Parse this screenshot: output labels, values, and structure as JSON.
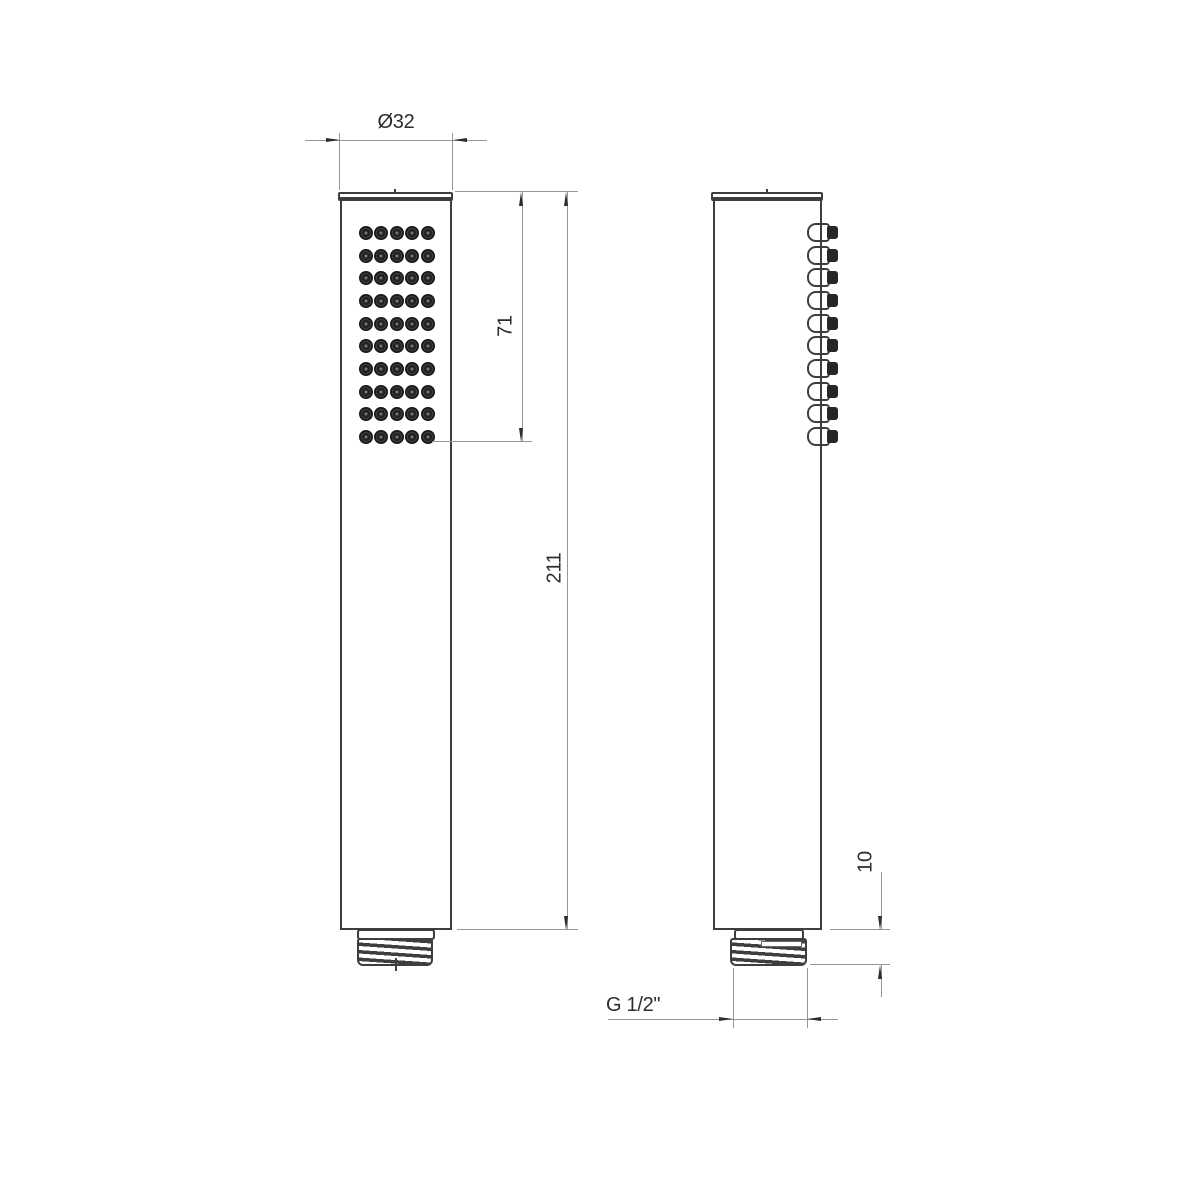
{
  "drawing": {
    "type": "technical-drawing",
    "subject": "handheld-shower-head-two-views",
    "views": {
      "front": {
        "nozzle_rows": 10,
        "nozzle_cols": 5
      },
      "side": {
        "nozzle_count": 10
      }
    },
    "dimensions": {
      "diameter_label": "Ø32",
      "spray_face_length_label": "71",
      "overall_length_label": "211",
      "thread_length_label": "10",
      "thread_spec_label": "G 1/2\""
    },
    "colors": {
      "background": "#ffffff",
      "outline": "#3e3e3e",
      "dimension_line": "#979797",
      "arrow_and_text": "#2d2d2d",
      "nozzle_dark": "#222222"
    }
  }
}
